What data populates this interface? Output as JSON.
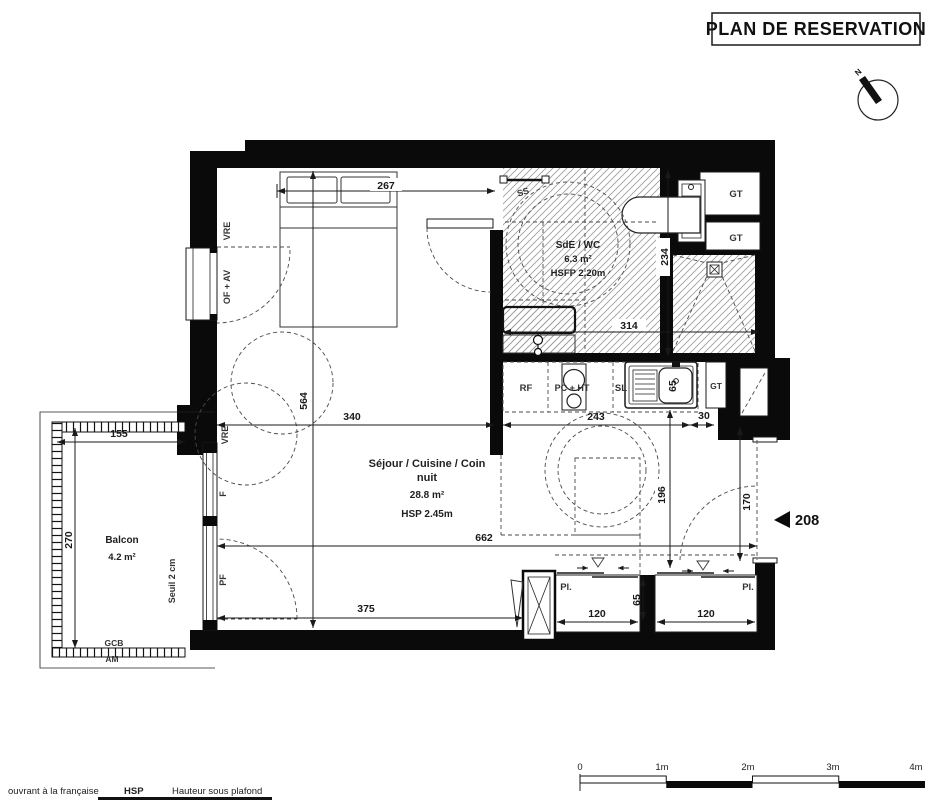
{
  "title": "PLAN DE RESERVATION",
  "compass": {
    "north": "N"
  },
  "unit": {
    "number": "208"
  },
  "rooms": {
    "sejour": {
      "line1": "Séjour / Cuisine / Coin",
      "line2": "nuit",
      "area": "28.8 m²",
      "ceiling": "HSP 2.45m"
    },
    "sde": {
      "name": "SdE / WC",
      "area": "6.3 m²",
      "ceiling": "HSFP 2.20m"
    },
    "balcon": {
      "name": "Balcon",
      "area": "4.2 m²",
      "threshold": "Seuil 2 cm"
    }
  },
  "wall_labels": {
    "vre_top": "VRE",
    "of_av": "OF + AV",
    "vre_mid": "VRE",
    "f": "F",
    "pf": "PF",
    "gcb": "GCB",
    "am": "AM",
    "ss": "SS"
  },
  "fixtures": {
    "gt": "GT",
    "rf": "RF",
    "pc_ht": "PC + HT",
    "sl": "SL",
    "pl": "Pl."
  },
  "dimensions": {
    "bed_width": "267",
    "room_height": "564",
    "room_width_top": "340",
    "room_width": "662",
    "room_width_bottom": "375",
    "balcony_width": "155",
    "balcony_depth": "270",
    "bath_depth": "234",
    "bath_width": "314",
    "kitchen_width": "243",
    "kitchen_gap": "30",
    "entry_depth": "196",
    "entry_height": "170",
    "sink_width": "65",
    "closet1_width": "120",
    "closet_depth": "65",
    "closet2_width": "120"
  },
  "scale_bar": {
    "t0": "0",
    "t1": "1m",
    "t2": "2m",
    "t3": "3m",
    "t4": "4m"
  },
  "legend": {
    "term1": "ouvrant à la française",
    "abbr1": "HSP",
    "def1": "Hauteur sous plafond"
  },
  "colors": {
    "wall": "#0a0a0a",
    "hatch": "#9a9a9a",
    "dash": "#4a4a4a"
  }
}
